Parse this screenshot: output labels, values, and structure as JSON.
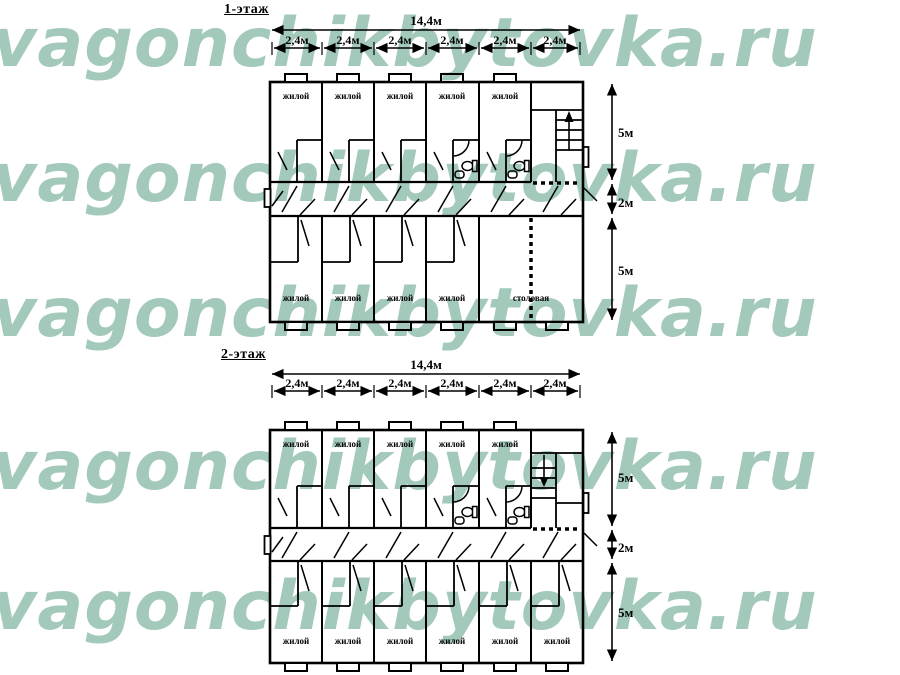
{
  "watermark": {
    "text": "vagonchikbytovka.ru",
    "color": "#a2c9ba"
  },
  "floor1": {
    "title": "1-этаж",
    "total_width": "14,4м",
    "module_widths": [
      "2,4м",
      "2,4м",
      "2,4м",
      "2,4м",
      "2,4м",
      "2,4м"
    ],
    "heights": {
      "top": "5м",
      "corridor": "2м",
      "bottom": "5м"
    },
    "top_rooms": [
      "жилой",
      "жилой",
      "жилой",
      "жилой",
      "жилой"
    ],
    "bottom_rooms": [
      "жилой",
      "жилой",
      "жилой",
      "жилой",
      "столовая"
    ]
  },
  "floor2": {
    "title": "2-этаж",
    "total_width": "14,4м",
    "module_widths": [
      "2,4м",
      "2,4м",
      "2,4м",
      "2,4м",
      "2,4м",
      "2,4м"
    ],
    "heights": {
      "top": "5м",
      "corridor": "2м",
      "bottom": "5м"
    },
    "top_rooms": [
      "жилой",
      "жилой",
      "жилой",
      "жилой",
      "жилой"
    ],
    "bottom_rooms": [
      "жилой",
      "жилой",
      "жилой",
      "жилой",
      "жилой",
      "жилой"
    ]
  }
}
